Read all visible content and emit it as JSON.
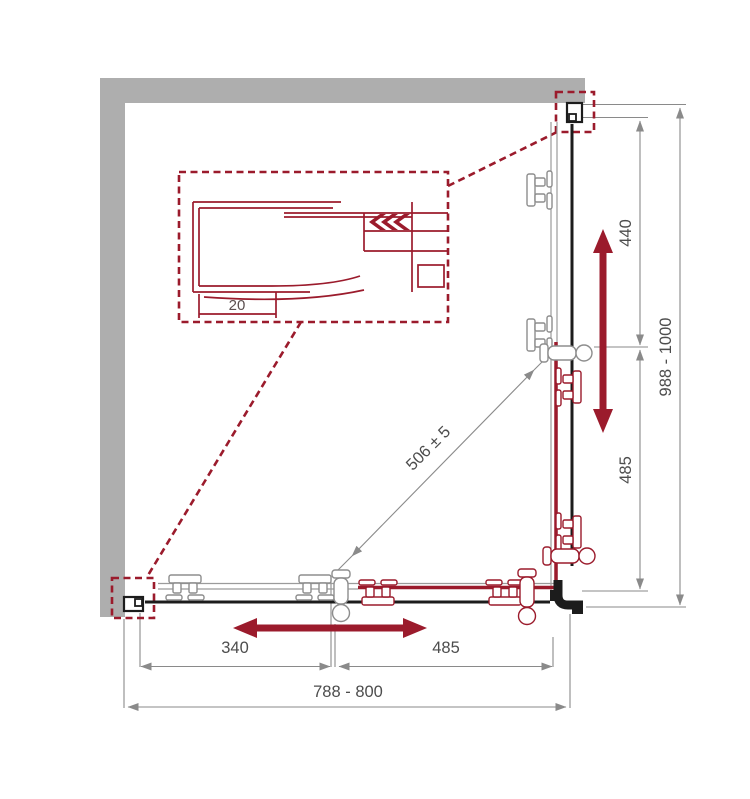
{
  "drawing": {
    "title": "Corner shower enclosure installation diagram (top view)",
    "colors": {
      "accent_red": "#9b1b2c",
      "wall_gray": "#aeaeae",
      "dimension_gray": "#8a8a8a",
      "ink_black": "#1c1c1c",
      "label_gray": "#4d4d4d"
    },
    "labels": {
      "detail_profile_width": "20",
      "right_upper": "440",
      "right_lower": "485",
      "right_overall": "988 - 1000",
      "diagonal": "506 ± 5",
      "bottom_left": "340",
      "bottom_right": "485",
      "bottom_overall": "788 - 800"
    }
  }
}
